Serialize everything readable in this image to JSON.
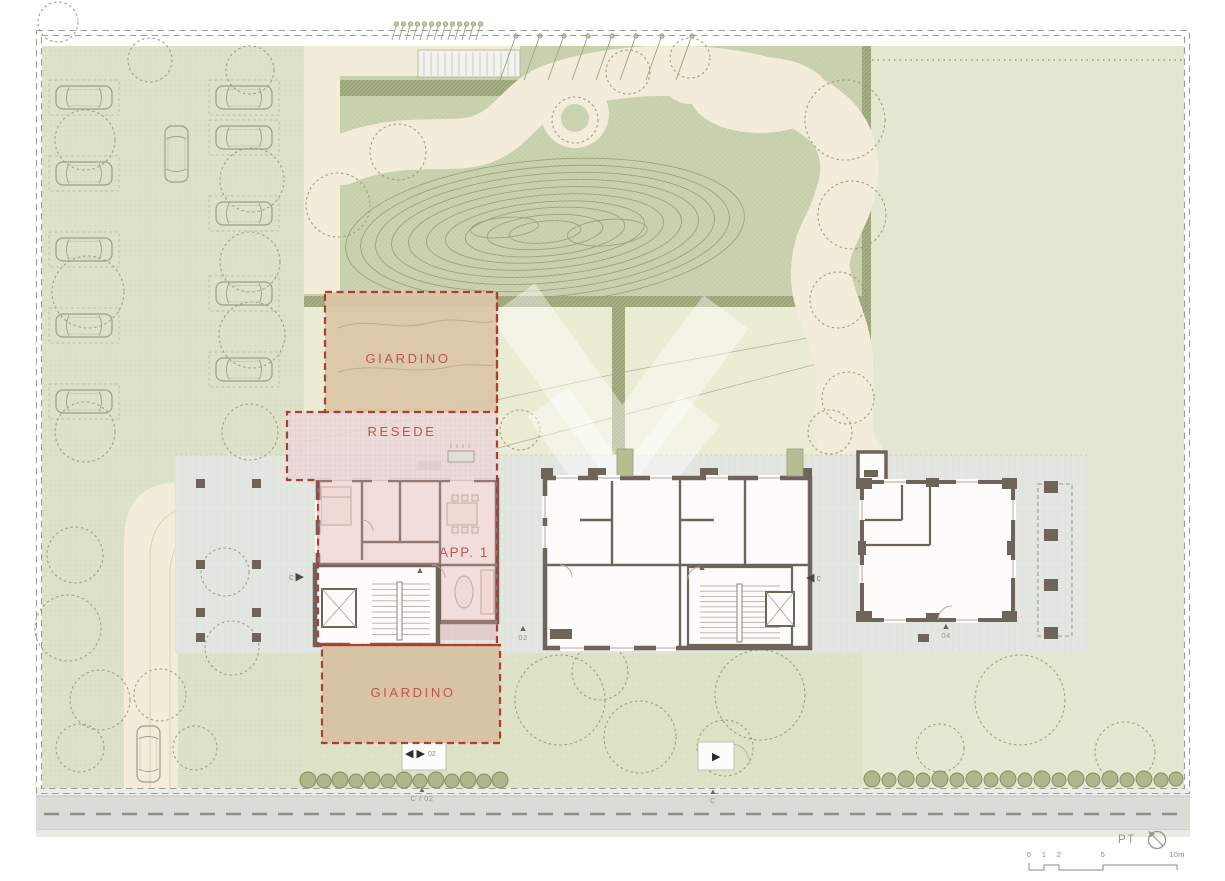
{
  "areas": {
    "garden_top_label": "GIARDINO",
    "resede_label": "RESEDE",
    "apartment_label": "APP. 1",
    "garden_bottom_label": "GIARDINO"
  },
  "markers": {
    "section_left_letter": "c",
    "section_right_letter": "c",
    "door_left_number": "02",
    "door_right_number": "04",
    "gate_left_number": "02",
    "road_gate_left_label": "C / 02",
    "road_gate_right_label": "C",
    "glyphs": {
      "up_triangle": "▲",
      "left_triangle": "◀",
      "right_triangle": "▶"
    }
  },
  "title_block": {
    "floor_label": "PT",
    "north_icon": "north-compass-icon"
  },
  "scale_bar": {
    "ticks": [
      "0",
      "1",
      "2",
      "5",
      "10m"
    ]
  },
  "colors": {
    "boundary_dash": "#9e9e94",
    "accent_red_dash": "#b23c32",
    "label_red": "#c0564c",
    "wall_brown": "#6e6459",
    "garden_tan": "#d9c6a7",
    "resede_pink": "#ecd9d9",
    "olive_green": "#cbd2b2",
    "lawn_green": "#e4e8d1",
    "path_cream": "#f2ecd8",
    "terrace_grey": "#e4e6e1",
    "road_grey": "#dbdbd7"
  }
}
